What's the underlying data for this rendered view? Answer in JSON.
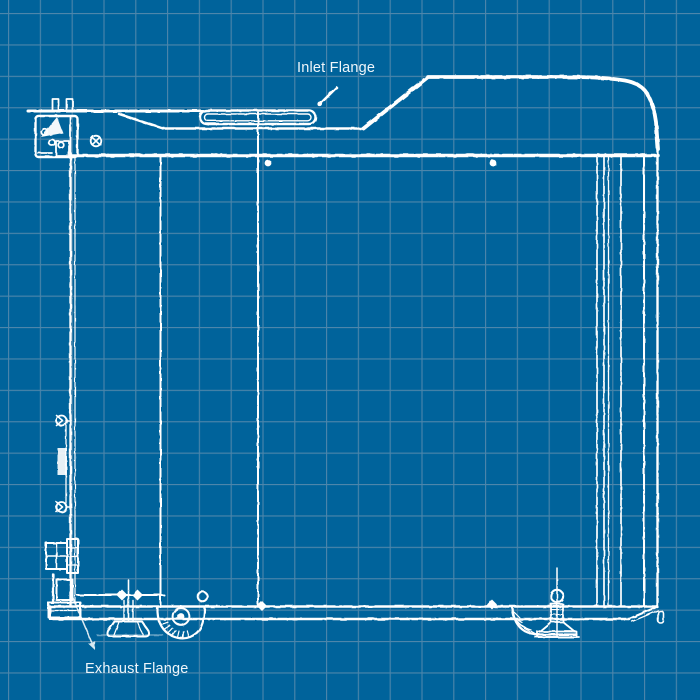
{
  "labels": {
    "inlet_flange": "Inlet Flange",
    "exhaust_flange": "Exhaust Flange"
  },
  "colors": {
    "background": "#00639b",
    "grid": "#4d86ab",
    "line": "#ffffff",
    "label_text": "#eef5fa"
  }
}
